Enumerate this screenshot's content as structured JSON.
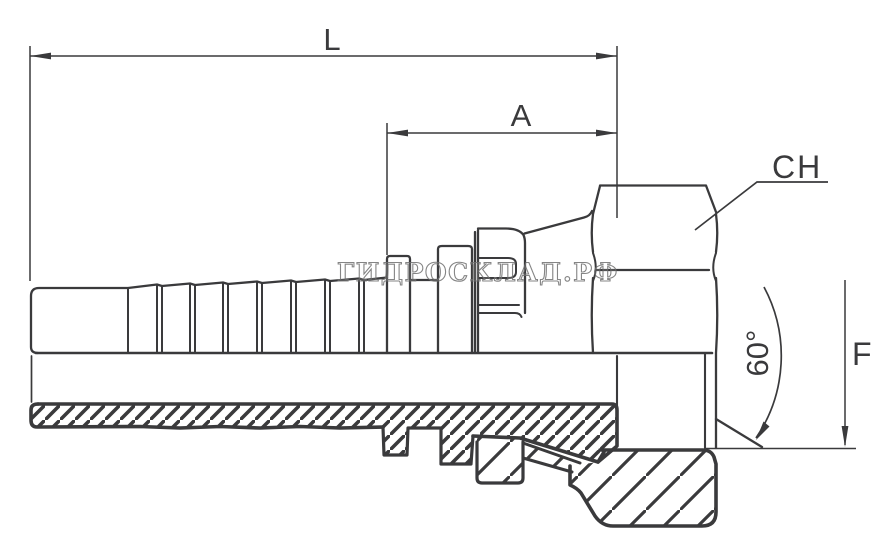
{
  "drawing": {
    "type": "technical-drawing-hose-fitting",
    "labels": {
      "overall_length": "L",
      "shank_length": "A",
      "hex_size": "CH",
      "cone_angle": "60°",
      "thread_size": "F"
    },
    "watermark": {
      "text": "ГИДРОСКЛАД.РФ",
      "color": "#707070"
    },
    "colors": {
      "background": "#ffffff",
      "line": "#3a3a3c"
    }
  }
}
